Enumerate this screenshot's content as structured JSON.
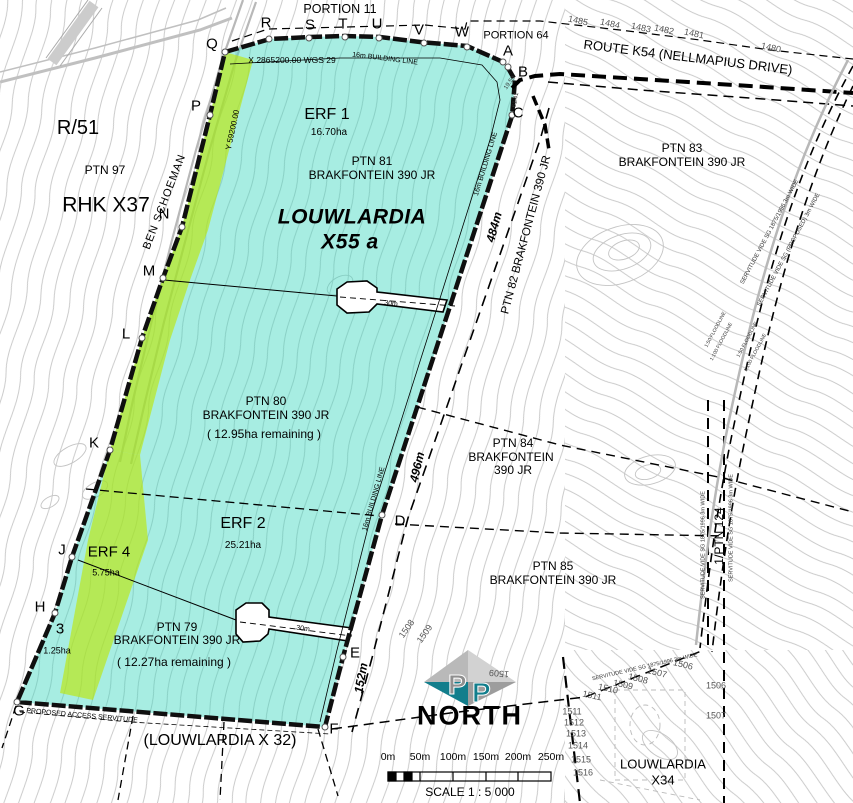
{
  "map_title": "LOUWLARDIA X55 a",
  "colors": {
    "township_fill": "#ADEFE3",
    "erf4_fill": "#D6ED62",
    "boundary": "#0f0f0f",
    "contour": "#c6c6c6",
    "road_gray": "#b8b8b8",
    "logo_teal": "#127e8c",
    "logo_gray": "#b9b9b9"
  },
  "corner_letters": [
    "Q",
    "R",
    "S",
    "T",
    "U",
    "V",
    "W",
    "A",
    "B",
    "C",
    "D",
    "E",
    "F",
    "G",
    "H",
    "J",
    "K",
    "L",
    "M",
    "N",
    "P",
    "3"
  ],
  "labels": {
    "portion11": "PORTION 11",
    "portion64": "PORTION 64",
    "route_k54": "ROUTE K54 (NELLMAPIUS DRIVE)",
    "r51": "R/51",
    "ptn97": "PTN 97",
    "rhk_x37": "RHK X37",
    "ben_schoeman": "BEN SCHOEMAN",
    "coord_x": "X 2865200.00  WGS 29",
    "coord_y": "Y 59200.00",
    "building_line": "16m BUILDING LINE",
    "erf1": "ERF 1",
    "erf1_area": "16.70ha",
    "ptn81": "PTN 81",
    "brakfontein": "BRAKFONTEIN 390 JR",
    "township1": "LOUWLARDIA",
    "township2": "X55 a",
    "ptn83": "PTN 83",
    "ptn82_road": "PTN 82 BRAKFONTEIN 390 JR",
    "dim_484": "484m",
    "dim_496": "496m",
    "dim_152": "152m",
    "dim_19_59": "19.59",
    "dim_61_41": "61.41",
    "ptn80": "PTN 80",
    "ptn80_rem": "( 12.95ha remaining )",
    "ptn84_1": "PTN 84",
    "ptn84_2": "BRAKFONTEIN",
    "ptn84_3": "390 JR",
    "erf2": "ERF 2",
    "erf2_area": "25.21ha",
    "ptn85": "PTN 85",
    "erf4": "ERF 4",
    "erf4_area": "5.75ha",
    "ptn79": "PTN 79",
    "ptn79_rem": "( 12.27ha remaining )",
    "erf3_area": "1.25ha",
    "flag_width": "30m",
    "access_servitude": "PROPOSED ACCESS SERVITUDE",
    "louwlardia_x32": "(LOUWLARDIA X 32)",
    "ptn124": "1/PTN 124",
    "servitude_3m_a": "SERVITUDE VIDE SG 1875/1996 3m WIDE",
    "servitude_3m_b": "SERVITUDE VIDE SG (PROPOSED) 3m WIDE",
    "floodline_50": "1:50 FLOODLINE",
    "floodline_100": "1:100 FLOODLINE",
    "north": "NORTH",
    "logo_p": "P",
    "louwlardia_x34_1": "LOUWLARDIA",
    "louwlardia_x34_2": "X34"
  },
  "contours_top": [
    "1485",
    "1484",
    "1483",
    "1482",
    "1481",
    "1480"
  ],
  "contours_diag": [
    "1511",
    "1510",
    "1509",
    "1508",
    "1507",
    "1506"
  ],
  "contours_col": [
    "1511",
    "1512",
    "1513",
    "1514",
    "1515",
    "1516"
  ],
  "contours_right": [
    "1506",
    "1507"
  ],
  "contours_near_e": [
    "1508",
    "1509"
  ],
  "contour_flip": "1509",
  "scale_bar": {
    "ticks": [
      "0m",
      "50m",
      "100m",
      "150m",
      "200m",
      "250m"
    ],
    "caption": "SCALE 1 : 5 000"
  }
}
